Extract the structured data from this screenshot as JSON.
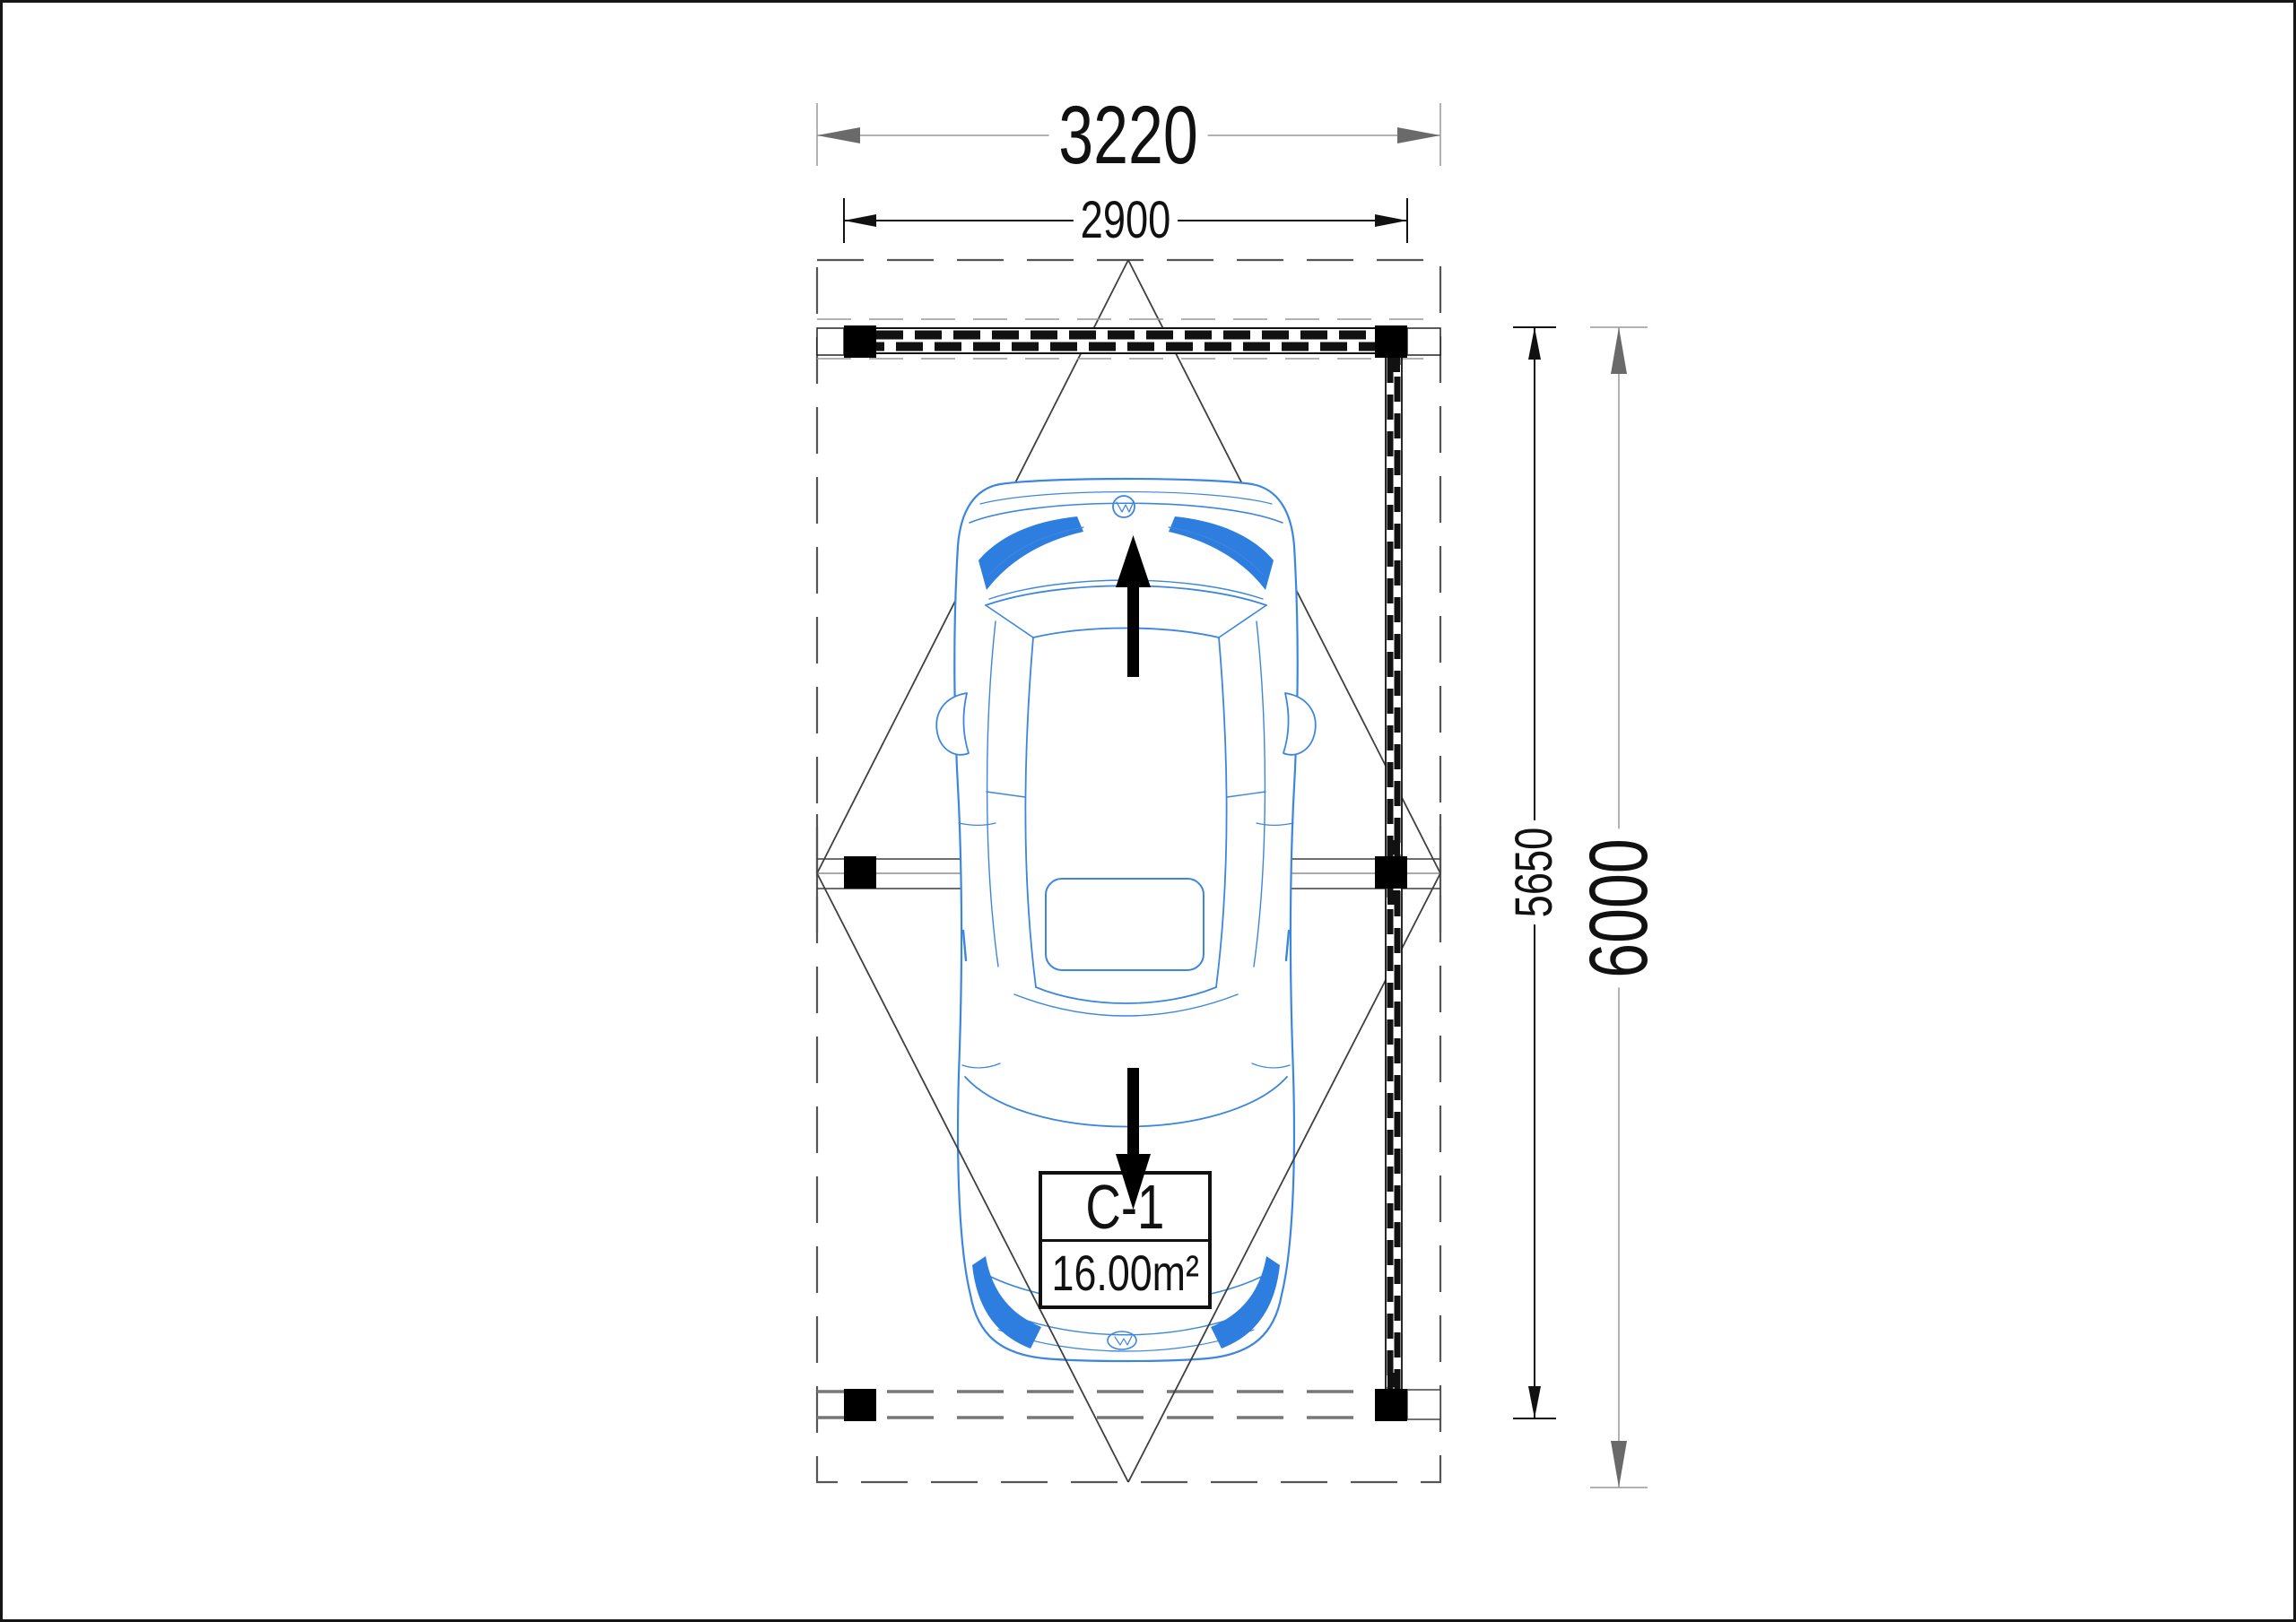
{
  "plan": {
    "unit": {
      "id": "C-1",
      "area": "16.00m²"
    },
    "dimensions": {
      "overall_width": "3220",
      "post_span_width": "2900",
      "wall_length": "5650",
      "overall_length": "6000"
    },
    "colors": {
      "car_line_blue": "#3c86de",
      "car_accent_blue": "#2e7ee0",
      "dim_arrow_gray": "#6a6a6a",
      "dim_line_gray": "#999999",
      "structure_black": "#111111",
      "roof_dash_gray": "#555555"
    }
  }
}
